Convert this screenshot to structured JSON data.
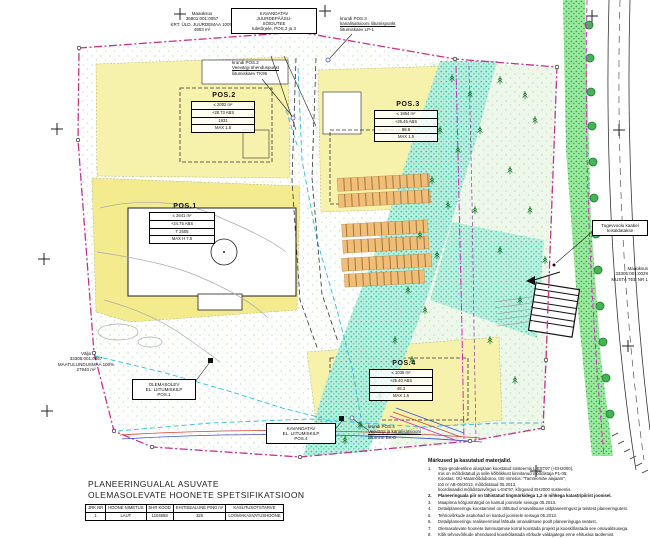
{
  "colors": {
    "boundary_magenta": "#c2338f",
    "utility_magenta": "#d429c4",
    "water_cyan": "#35b8e0",
    "parcel_yellow": "#f6f1ab",
    "greenway_cyan": "#b4efdf",
    "verge_green": "#9ce89e"
  },
  "plots": {
    "pos1": {
      "title": "POS.1",
      "rows": [
        "≤ 2641 m²",
        "+24.75 ABS",
        "T 2505",
        "MAX H 7.5"
      ]
    },
    "pos2": {
      "title": "POS.2",
      "rows": [
        "≤ 2002 m²",
        "+28.73 ABS",
        "1931",
        "MAX 1.5"
      ]
    },
    "pos3": {
      "title": "POS.3",
      "rows": [
        "≤ 1854 m²",
        "+26.45 ABS",
        "88.8",
        "MAX 1.5"
      ]
    },
    "pos4": {
      "title": "POS.4",
      "rows": [
        "≤ 1035 m²",
        "+25.40 ABS",
        "48.3",
        "MAX 1.5"
      ]
    }
  },
  "labels": {
    "parcel_nw": {
      "lines": [
        "Maaüksus",
        "36801:001:0057",
        "KRT. ÜLD. JUURDEMAA 100%",
        "4903 m²"
      ]
    },
    "access_box": {
      "lines": [
        "KAVANDATAV",
        "JUURDEPÄÄSU-",
        "SÕIDUTEE",
        "tuletõrjele, POS.2 ja 3"
      ]
    },
    "water_pos2": {
      "lines": [
        "krundi POS.2",
        "Veevärgi ühenduspunkt",
        "liitumiskaev TK95"
      ]
    },
    "sewer_pos3": {
      "lines": [
        "krundi POS.3",
        "kanalisatsiooni liitumispunkt",
        "liitumiskaev LP-1"
      ]
    },
    "parcel_w": {
      "lines": [
        "Välja",
        "33305:001:0067",
        "MAATULUNDUSMAA 100%",
        "27940 m²"
      ]
    },
    "cabinet_pos1": {
      "lines": [
        "OLEMASOLEV",
        "EL. LIITUMISKILP",
        "POS.1"
      ]
    },
    "cabinet_pos4": {
      "lines": [
        "KAVANDATAV",
        "EL. LIITUMISKILP",
        "POS.4"
      ]
    },
    "water_pos4": {
      "lines": [
        "krundi POS.4",
        "Veevärgi ja kanalisatsiooni",
        "liitumine BK-0"
      ]
    },
    "cable_box": {
      "lines": [
        "Tugevvoolu kaabel",
        "teisaldatakse"
      ]
    },
    "parcel_e": {
      "lines": [
        "Maaüksus",
        "33305:001:0029",
        "MUSTA TEE NR 1"
      ]
    }
  },
  "title_block": {
    "line1": "PLANEERINGUALAL ASUVATE",
    "line2": "OLEMASOLEVATE HOONETE SPETSIFIKATSIOON"
  },
  "spec_table": {
    "headers": [
      "JRK NR",
      "HOONE NIMETUS",
      "EHR KOOD",
      "EHITISEALUNE PIND m²",
      "KASUTUSOTSTARVE"
    ],
    "row": [
      "1",
      "LAUT",
      "1104658",
      "325",
      "LOOMAKASVATUSHOONE"
    ]
  },
  "notes": {
    "heading": "Märkused ja kasutatud materjalid.",
    "items": [
      {
        "num": "1.",
        "lines": [
          "Topo-geodeetiline alusplaan koostatud süsteemis L-EST97 (+EH2000),",
          "mis on mõõdistatud ja selle kõlblikkust kinnitanud mõõdistaja P1-05;",
          "Koostas: OÜ Maamõõdubüroo, töö nimetus: \"Tammemäe alajaam\",",
          "töö nr AB-05/2013, mõõdistatud 05.2013,",
          "koordinaadid mõõdistusvõrgus L-Est'97, kõrgused EH2000 süsteemis."
        ]
      },
      {
        "num": "2.",
        "lines": [
          "Planeeringuala piir on tähistatud tingmärkidega 1,2 m nihkega katastripiirist joonisel."
        ]
      },
      {
        "num": "3.",
        "lines": [
          "Maapinna kõrgusmärgid on kantud joonisele seisuga 05.2013."
        ]
      },
      {
        "num": "4.",
        "lines": [
          "Detailplaneeringu koostamisel on lähtutud omavalitsuse üldplaneeringust ja teistest planeeringutest."
        ]
      },
      {
        "num": "5.",
        "lines": [
          "Tehnovõrkude asukohad on kantud joonisele seisuga 05.2013."
        ]
      },
      {
        "num": "6.",
        "lines": [
          "Detailplaneeringu realiseerimisel lähtuda omavalitsuse poolt planeeringuga seatust."
        ]
      },
      {
        "num": "7.",
        "lines": [
          "Olemasolevate hoonete lammutamise korral koostada projekt ja kooskõlastada see omavalitsusega."
        ]
      },
      {
        "num": "8.",
        "lines": [
          "Kõik tehnovõrkude ühendused kooskõlastada võrkude valdajatega enne ehitusloa taotlemist."
        ]
      }
    ]
  }
}
